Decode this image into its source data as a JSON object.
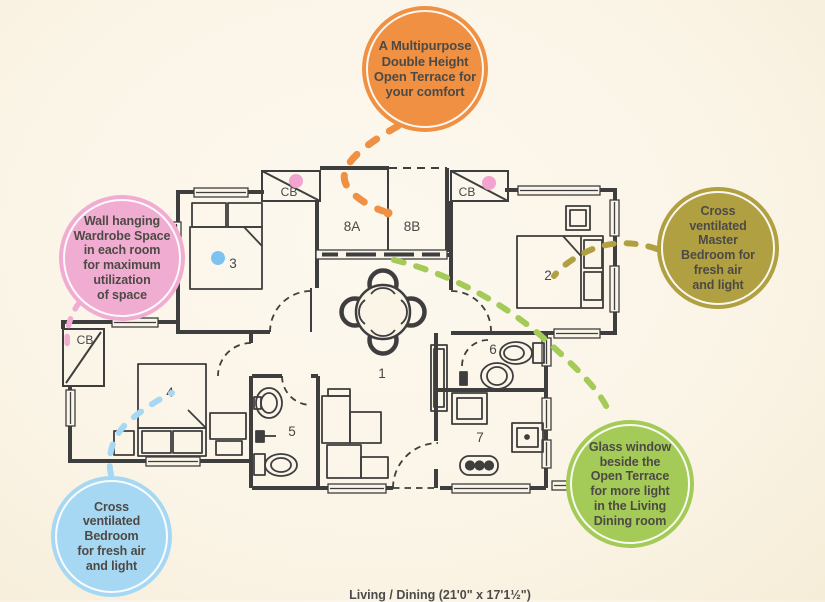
{
  "background": {
    "color": "#fbf5e8"
  },
  "caption": {
    "text": "Living / Dining (21'0\" x 17'1½\")"
  },
  "bubbles": {
    "terrace": {
      "text": "A Multipurpose\nDouble Height\nOpen Terrace for\nyour comfort",
      "color": "#EF9043"
    },
    "wardrobe": {
      "text": "Wall hanging\nWardrobe Space\nin each room\nfor maximum\nutilization\nof space",
      "color": "#F1ADD1"
    },
    "master": {
      "text": "Cross\nventilated\nMaster\nBedroom for\nfresh air\nand light",
      "color": "#B0A042"
    },
    "bedroom": {
      "text": "Cross\nventilated\nBedroom\nfor fresh air\nand light",
      "color": "#A7D8F3"
    },
    "glass": {
      "text": "Glass window\nbeside the\nOpen Terrace\nfor more light\nin the Living\nDining room",
      "color": "#A4CA57"
    }
  },
  "plan": {
    "labels": {
      "living": "1",
      "master": "2",
      "bedroom3": "3",
      "bedroom4": "4",
      "bath5": "5",
      "bath6": "6",
      "kitchen": "7",
      "terrace_a": "8A",
      "terrace_b": "8B",
      "cupboard1": "CB",
      "cupboard2": "CB",
      "cupboard3": "CB"
    },
    "colors": {
      "wall": "#3e3e3e",
      "connector_orange": "#EF9043",
      "connector_pink": "#F1ADD1",
      "connector_olive": "#B0A042",
      "connector_blue": "#A7D8F3",
      "connector_green": "#A4CA57",
      "dot_pink": "#F2A3CF",
      "dot_blue": "#7CC4EF"
    }
  }
}
